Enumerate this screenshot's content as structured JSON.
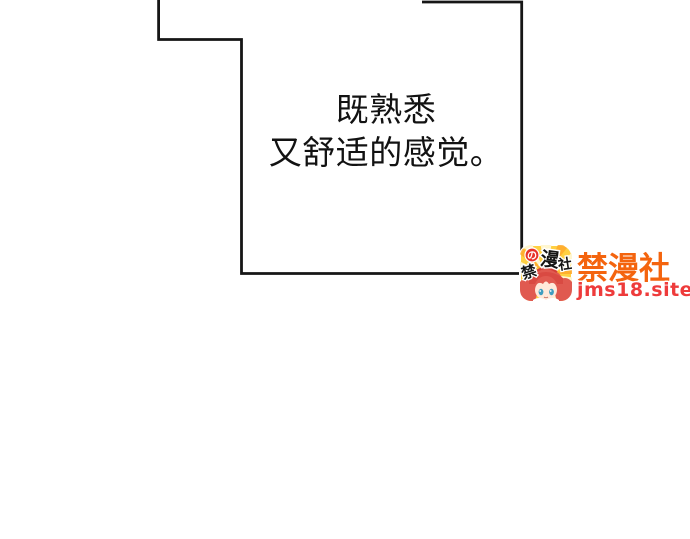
{
  "canvas": {
    "background": "#ffffff",
    "panel_line_color": "#161616"
  },
  "panel": {
    "dialogue": {
      "line1": "既熟悉",
      "line2": "又舒适的感觉。"
    }
  },
  "watermark": {
    "site_name": "禁漫社",
    "site_url": "jms18.site",
    "colors": {
      "site_name": "#f4640e",
      "site_url": "#ee3b3b",
      "icon_background": "#ffd042",
      "icon_hair": "#e05a50"
    },
    "logo": {
      "char_no": "の",
      "char_man": "漫",
      "char_she": "社",
      "char_jin": "禁"
    }
  }
}
